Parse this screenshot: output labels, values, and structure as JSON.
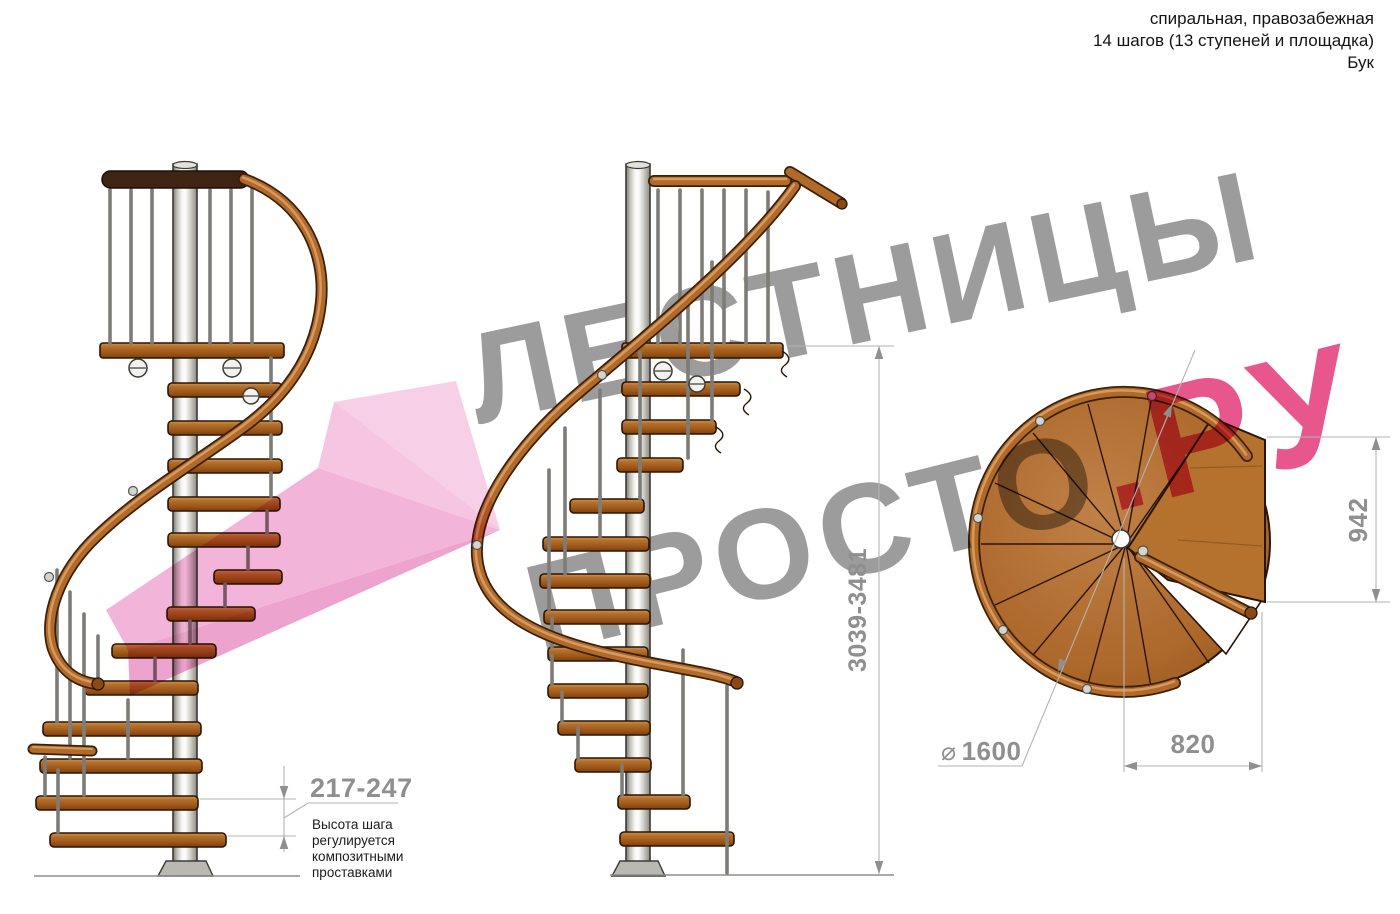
{
  "header": {
    "lines": [
      "спиральная, правозабежная",
      "14 шагов (13 ступеней и площадка)",
      "Бук"
    ]
  },
  "watermark": {
    "line1": "ЛЕСТНИЦЫ",
    "line2_gray": "ПРОСТО",
    "line2_pink": ".РУ"
  },
  "dimensions": {
    "step_height": {
      "value": "217-247",
      "note_lines": [
        "Высота шага",
        "регулируется",
        "композитными",
        "проставками"
      ]
    },
    "total_height": {
      "value": "3039-3481"
    },
    "landing_depth": {
      "value": "942"
    },
    "diameter": {
      "symbol": "⌀",
      "value": "1600"
    },
    "landing_width": {
      "value": "820"
    }
  },
  "colors": {
    "wm-gray": "#9c9c9c",
    "wm-pink": "#e7568c",
    "arrow-pink-1": "#f6c0e0",
    "arrow-pink-2": "#f1aed6",
    "arrow-pink-3": "#eb9cca",
    "dim-gray": "#8f8f8f",
    "dim-line": "#b3b3b3",
    "note-ink": "#1b1b1b",
    "header-ink": "#141414",
    "wood": "#a96019",
    "wood-edge": "#2a1505",
    "rail": "#b16a2a",
    "rail-hi": "#dca268",
    "rail-dark": "#3a2008",
    "platform-rail": "#3d2413"
  }
}
